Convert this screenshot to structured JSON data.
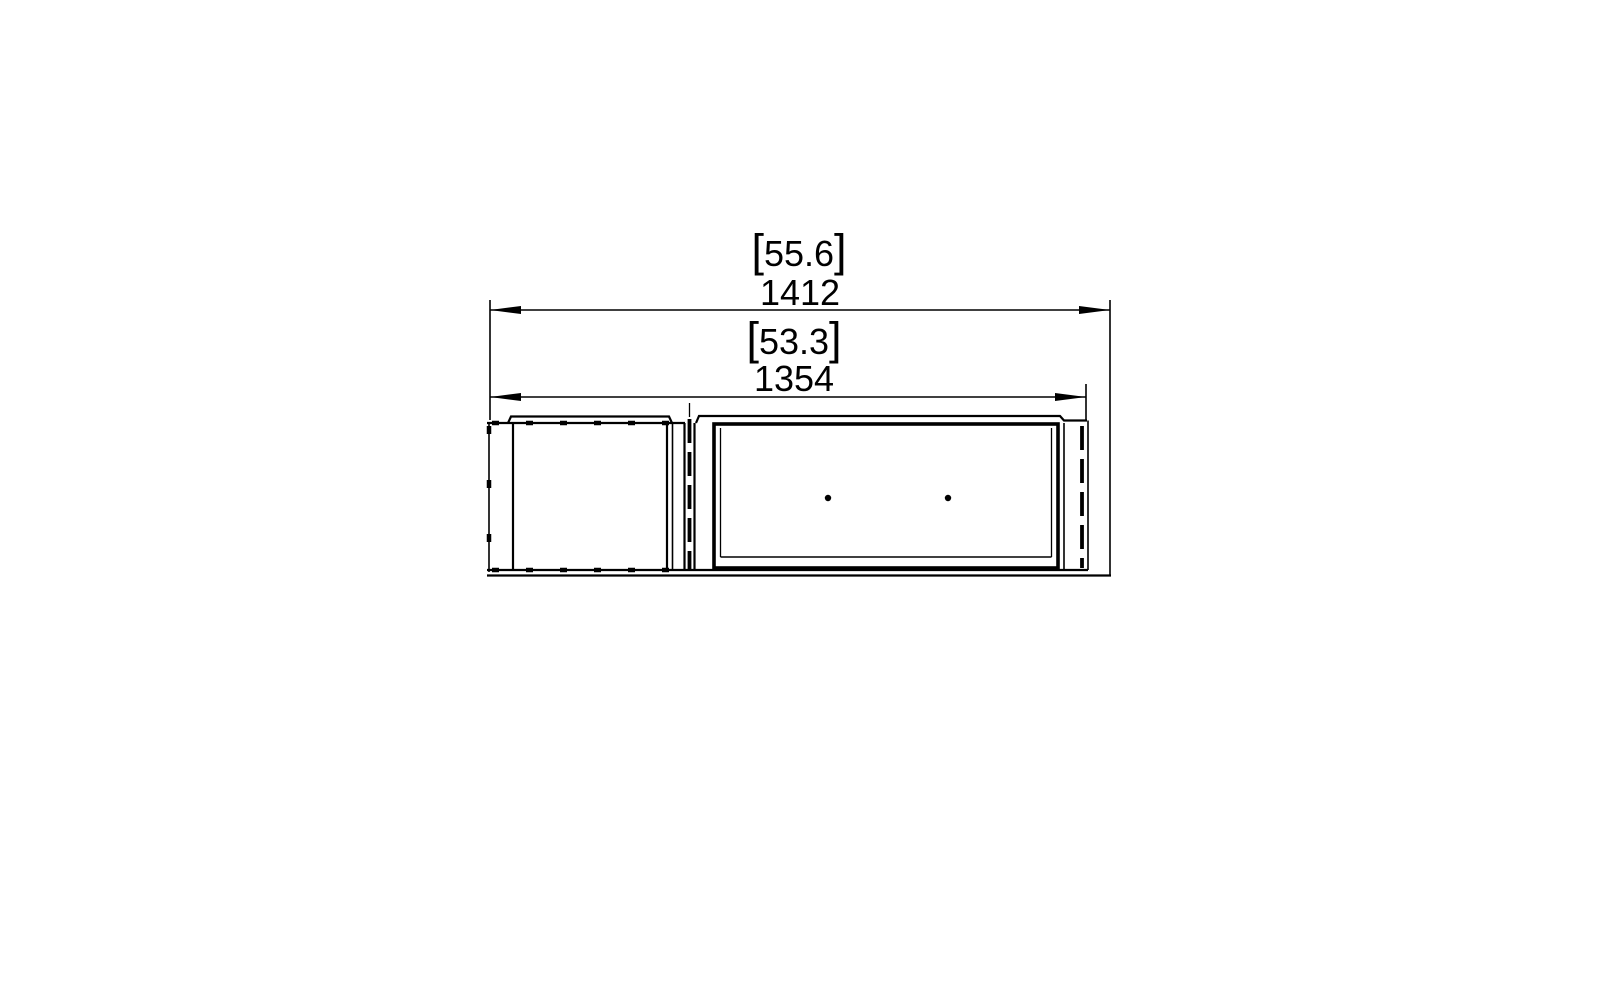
{
  "page": {
    "background": "#ffffff",
    "line_color": "#000000"
  },
  "brackets": {
    "open": "[",
    "close": "]"
  },
  "dimensions": [
    {
      "id": "dim-top",
      "metric": "1412",
      "imperial": "55.6"
    },
    {
      "id": "dim-bottom",
      "metric": "1354",
      "imperial": "53.3"
    }
  ],
  "plan_view": {
    "burner_holes": 2
  }
}
